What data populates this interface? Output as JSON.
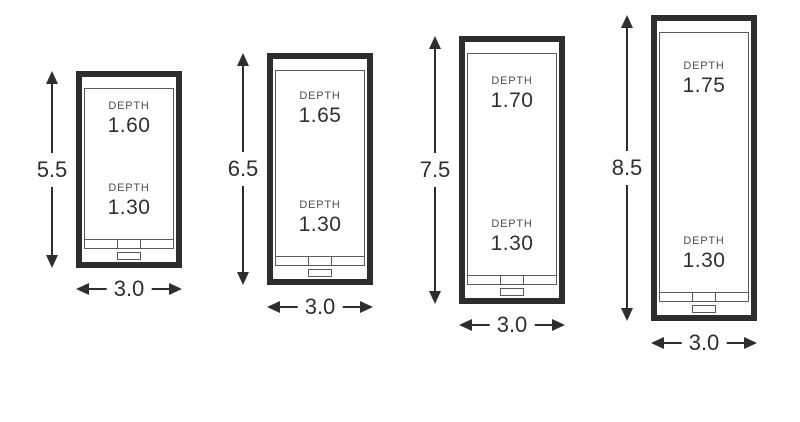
{
  "pools": [
    {
      "height_label": "5.5",
      "width_label": "3.0",
      "deep": {
        "label": "DEPTH",
        "value": "1.60"
      },
      "shallow": {
        "label": "DEPTH",
        "value": "1.30"
      }
    },
    {
      "height_label": "6.5",
      "width_label": "3.0",
      "deep": {
        "label": "DEPTH",
        "value": "1.65"
      },
      "shallow": {
        "label": "DEPTH",
        "value": "1.30"
      }
    },
    {
      "height_label": "7.5",
      "width_label": "3.0",
      "deep": {
        "label": "DEPTH",
        "value": "1.70"
      },
      "shallow": {
        "label": "DEPTH",
        "value": "1.30"
      }
    },
    {
      "height_label": "8.5",
      "width_label": "3.0",
      "deep": {
        "label": "DEPTH",
        "value": "1.75"
      },
      "shallow": {
        "label": "DEPTH",
        "value": "1.30"
      }
    }
  ],
  "colors": {
    "outline": "#2d2d2d",
    "thin_line": "#5a5a5b",
    "arrow": "#2e2e2e",
    "value_text": "#2f2f2f",
    "depth_label_text": "#4f4f4f",
    "background": "#ffffff"
  }
}
